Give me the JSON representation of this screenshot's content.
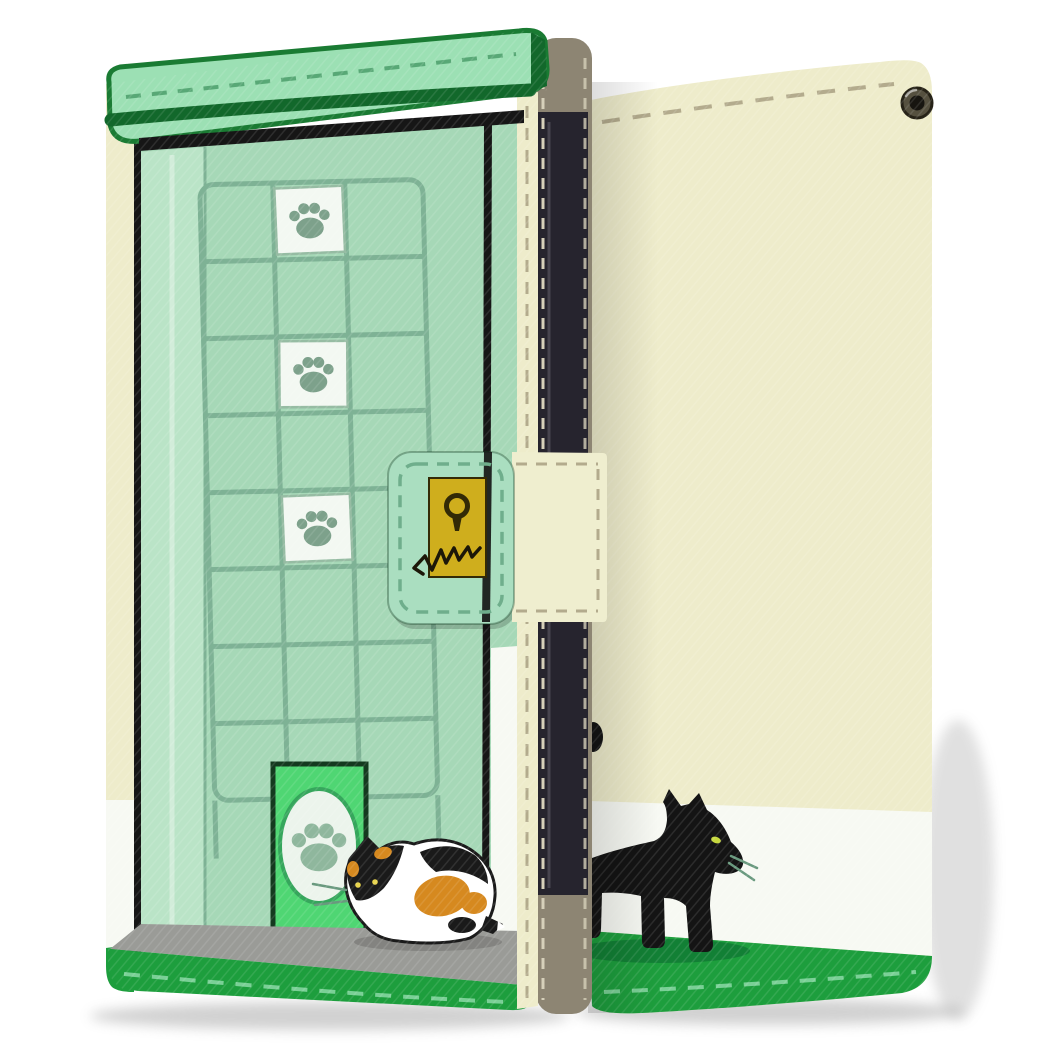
{
  "description": "Product photo of a flip wallet phone case shown in two views: closed front cover styled as a mint-green door with a tile grid, three white paw-print tiles, a bright green cat flap with a paw emblem, a crouching calico cat, and a clasp strap with a yellow keyhole plate with claw scratches; back cover in cream with a walking black cat on a white stripe over a green stitched hem, metal eyelet at top right.",
  "paw_tiles_count": 3,
  "cats": [
    "calico-cat-front",
    "black-cat-back"
  ],
  "colors": {
    "bg": "#ffffff",
    "cream": "#eeeccb",
    "whiteStripe": "#f7f9f3",
    "bandGreen": "#1d9e3d",
    "bandGreenDeep": "#128035",
    "bandStitch": "#7ad096",
    "stitchTaupe": "#b3ab8d",
    "capGreen": "#9ce0b4",
    "capRim": "#12682b",
    "capBorder": "#1a7b33",
    "capStitch": "#58a876",
    "doorMint": "#a6d8b7",
    "doorFrame": "#bae4c7",
    "gridLine": "#7eb295",
    "tileWhite": "#f3f8f2",
    "tileBorder": "#96bca3",
    "pawGray": "#7da18b",
    "pawDoor": "#8fb79d",
    "darkLine": "#161616",
    "catDoorGreen": "#4fd673",
    "catDoorOutline": "#143a1f",
    "catDoorEllipse": "#ecf4ec",
    "catDoorRing": "#36a65c",
    "floorGray": "#9a9b97",
    "strapMint": "#aadec0",
    "strapCream": "#efeecf",
    "strapStitch": "#6fae8c",
    "lockYellow": "#cfae1d",
    "lockDark": "#332a06",
    "scratchDark": "#1c1708",
    "spineTaupe": "#8d8573",
    "spineStitch": "#d6d0ba",
    "phoneDark": "#26242e",
    "phoneHighlight": "#55525e",
    "calicoWhite": "#ffffff",
    "calicoOrange": "#d6891f",
    "calicoBlack": "#1a1a1a",
    "calicoEye": "#e8d44d",
    "whisker": "#69997e",
    "blackCat": "#141414",
    "blackCatEye": "#c6d83e",
    "shadowGray": "#9a9a9a"
  }
}
